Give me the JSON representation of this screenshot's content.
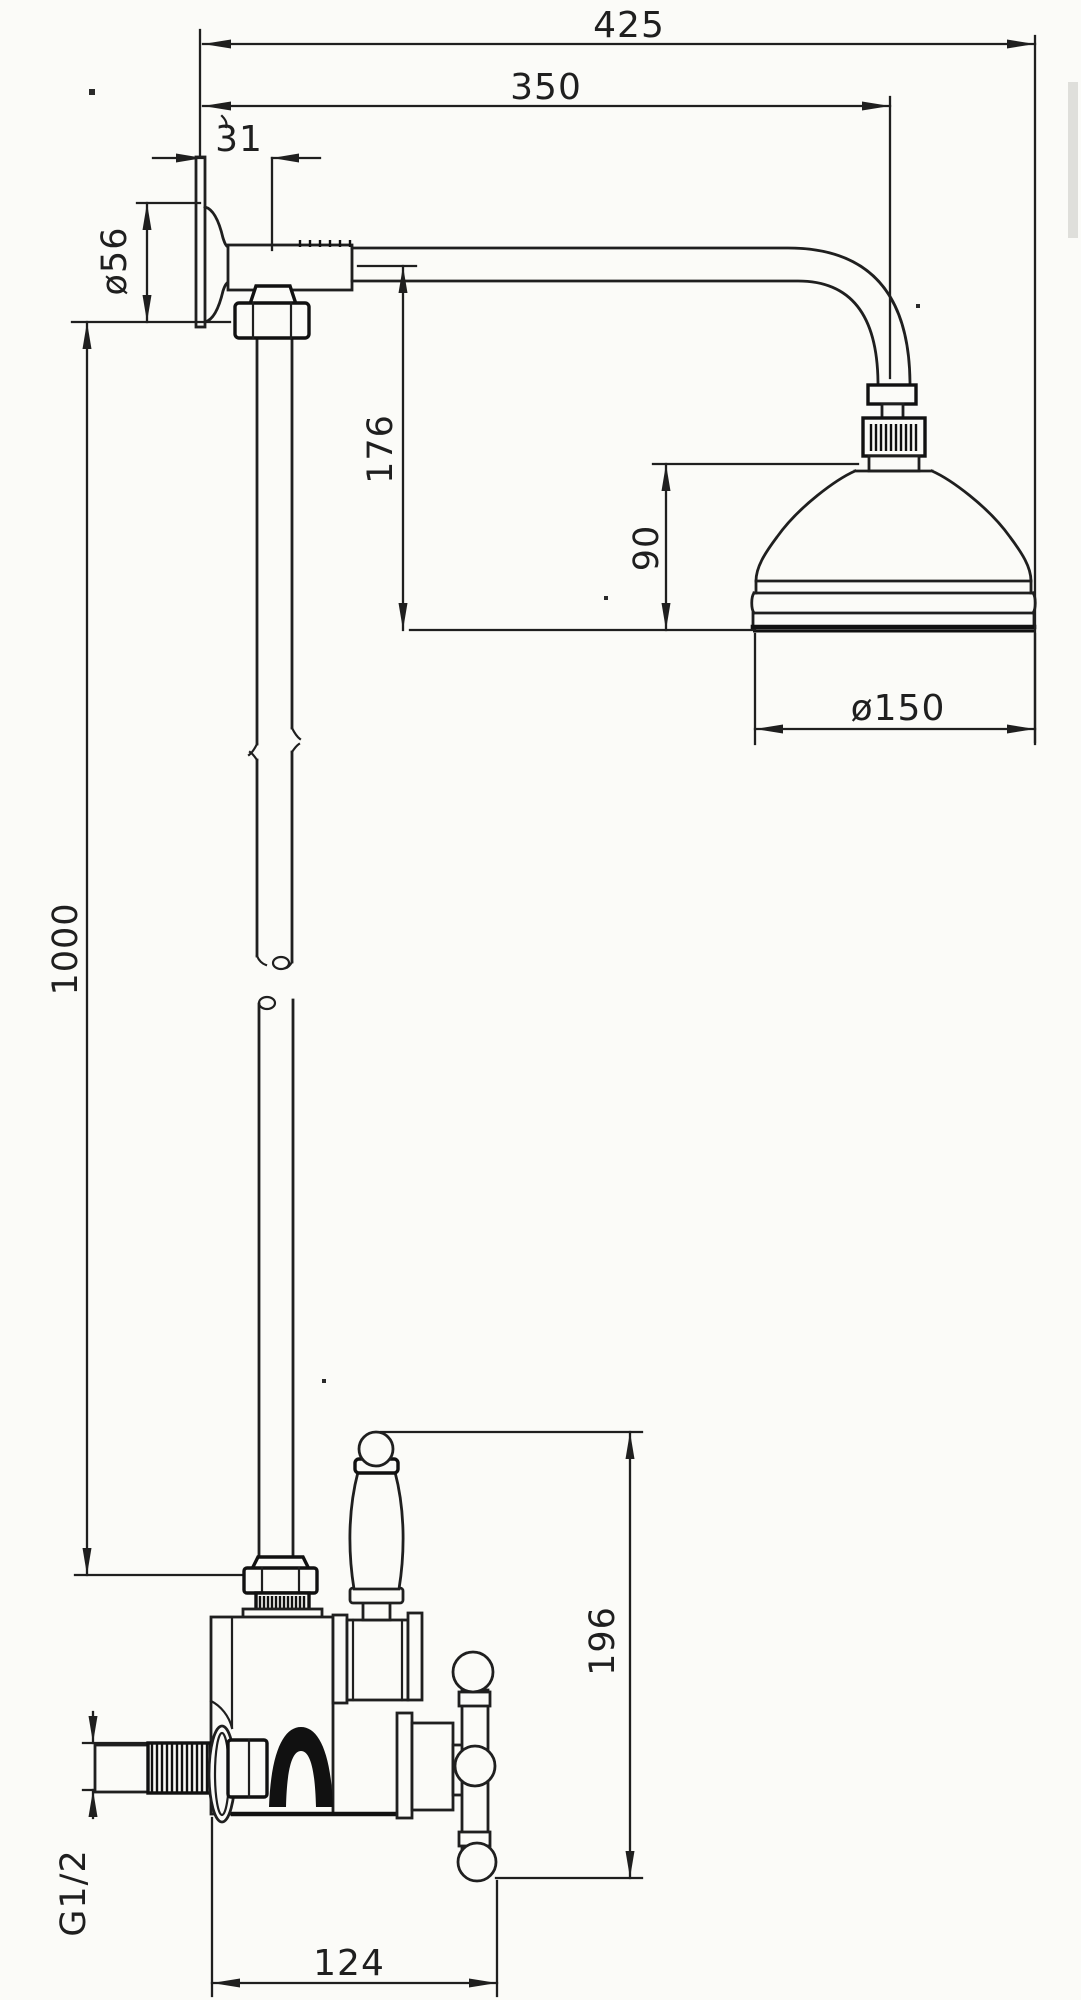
{
  "drawing": {
    "kind": "dimensioned technical drawing of exposed shower set (wall arm, shower head, riser pipe, valve)",
    "colors": {
      "ink": "#1f1f1f",
      "ink_bold": "#111111",
      "paper": "#fbfbf8"
    },
    "dims": {
      "d425": "425",
      "d350": "350",
      "d31": "31",
      "d56": "ø56",
      "d176": "176",
      "d90": "90",
      "d150": "ø150",
      "d1000": "1000",
      "d196": "196",
      "dg12": "G1/2",
      "d124": "124"
    }
  }
}
